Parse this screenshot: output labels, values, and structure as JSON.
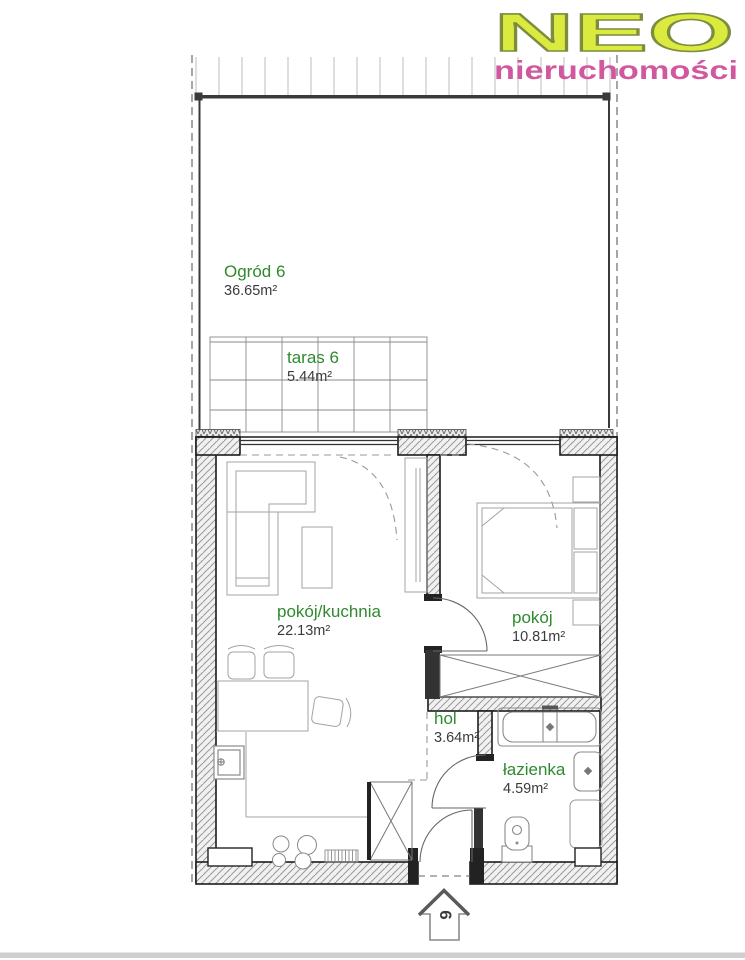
{
  "logo": {
    "name": "NEO",
    "subtitle": "nieruchomości",
    "name_color": "#dbea3e",
    "subtitle_color": "#d1589e"
  },
  "unit_marker": {
    "number": "6"
  },
  "rooms": [
    {
      "id": "ogrod",
      "name": "Ogród 6",
      "area": "36.65m²"
    },
    {
      "id": "taras",
      "name": "taras 6",
      "area": "5.44m²"
    },
    {
      "id": "pokoj_kuchnia",
      "name": "pokój/kuchnia",
      "area": "22.13m²"
    },
    {
      "id": "pokoj",
      "name": "pokój",
      "area": "10.81m²"
    },
    {
      "id": "hol",
      "name": "hol",
      "area": "3.64m²"
    },
    {
      "id": "lazienka",
      "name": "łazienka",
      "area": "4.59m²"
    }
  ],
  "colors": {
    "room_label": "#2f8a2f",
    "area_label": "#3b3b3b",
    "wall_line": "#1c1c1c"
  }
}
